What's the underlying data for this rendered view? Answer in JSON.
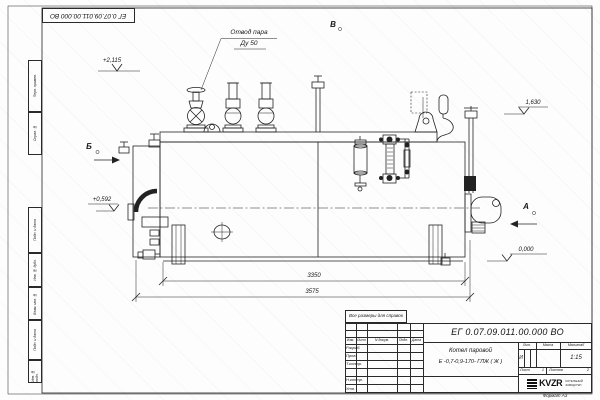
{
  "frame": {
    "corner_stamp": "ЕГ 0.07.09.011.00.000  ВО",
    "format_note": "Формат А3",
    "side_labels": [
      "Перв. примен.",
      "Справ. №",
      "Подп. и дата",
      "Инв. № дубл.",
      "Взам. инв. №",
      "Подп. и дата",
      "Инв. № подл."
    ]
  },
  "drawing": {
    "callout": {
      "line1": "Отвод пара",
      "line2": "Ду 50"
    },
    "views": {
      "a": "А",
      "b": "Б",
      "v": "В"
    },
    "elevations": {
      "e1": "+2,115",
      "e2": "1,630",
      "e3": "+0,592",
      "e4": "0,000"
    },
    "dimensions": {
      "d1": "3350",
      "d2": "3575"
    }
  },
  "title_block": {
    "note": "Все размеры для справок",
    "doc_number": "ЕГ 0.07.09.011.00.000  ВО",
    "name_line1": "Котел паровой",
    "name_line2": "Е -0,7-0,9-170- ГЛЖ ( Ж )",
    "col_izm": "Изм.",
    "col_list": "Лист",
    "col_ndoc": "N докум.",
    "col_podp": "Подп.",
    "col_data": "Дата",
    "row_razrab": "Разраб.",
    "row_prov": "Пров.",
    "row_tkontr": "Т.контр.",
    "row_nkontr": "Н.контр.",
    "row_utv": "Утв.",
    "lit_header": "Лит.",
    "mass_header": "Масса",
    "scale_header": "Масштаб",
    "lit_value": "И",
    "scale_value": "1:15",
    "sheet_label": "Лист",
    "sheet_value": "1",
    "sheets_label": "Листов",
    "sheets_value": "2",
    "logo_text": "KVZR",
    "logo_caption_line1": "КОТЕЛЬНЫЙ",
    "logo_caption_line2": "ЗАВОД РЭП"
  }
}
